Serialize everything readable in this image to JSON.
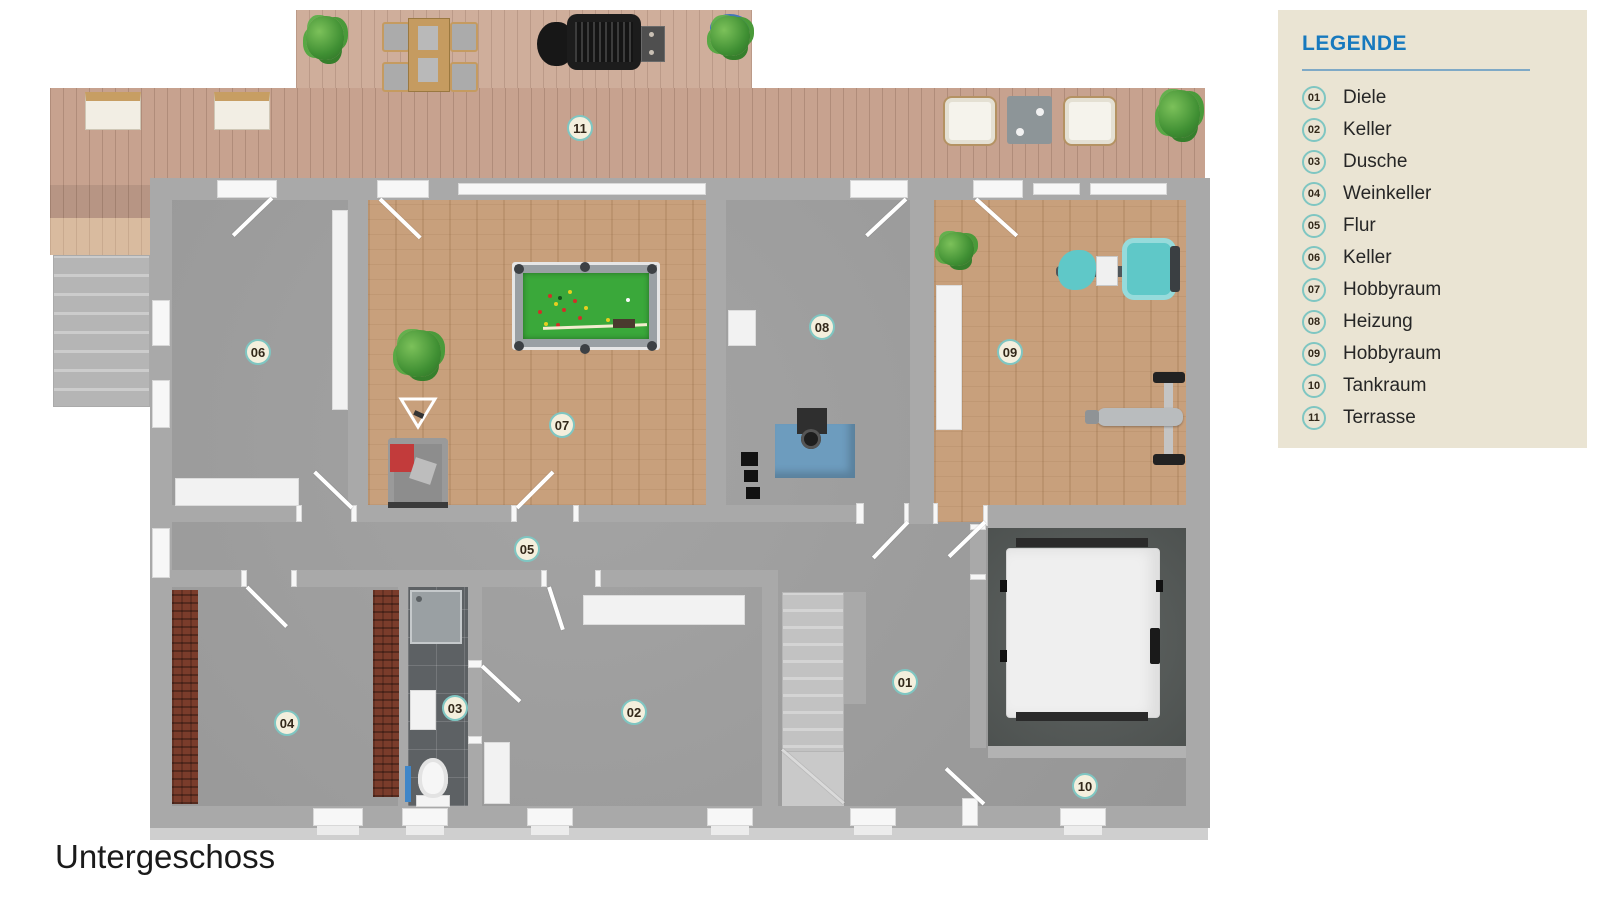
{
  "page": {
    "title": "Untergeschoss"
  },
  "legend": {
    "title": "LEGENDE",
    "items": [
      {
        "number": "01",
        "label": "Diele"
      },
      {
        "number": "02",
        "label": "Keller"
      },
      {
        "number": "03",
        "label": "Dusche"
      },
      {
        "number": "04",
        "label": "Weinkeller"
      },
      {
        "number": "05",
        "label": "Flur"
      },
      {
        "number": "06",
        "label": "Keller"
      },
      {
        "number": "07",
        "label": "Hobbyraum"
      },
      {
        "number": "08",
        "label": "Heizung"
      },
      {
        "number": "09",
        "label": "Hobbyraum"
      },
      {
        "number": "10",
        "label": "Tankraum"
      },
      {
        "number": "11",
        "label": "Terrasse"
      }
    ]
  },
  "floorplan": {
    "room_labels": [
      {
        "number": "01",
        "label": "Diele",
        "x": 905,
        "y": 682
      },
      {
        "number": "02",
        "label": "Keller",
        "x": 634,
        "y": 712
      },
      {
        "number": "03",
        "label": "Dusche",
        "x": 455,
        "y": 708
      },
      {
        "number": "04",
        "label": "Weinkeller",
        "x": 287,
        "y": 723
      },
      {
        "number": "05",
        "label": "Flur",
        "x": 527,
        "y": 549
      },
      {
        "number": "06",
        "label": "Keller",
        "x": 258,
        "y": 352
      },
      {
        "number": "07",
        "label": "Hobbyraum",
        "x": 562,
        "y": 425
      },
      {
        "number": "08",
        "label": "Heizung",
        "x": 822,
        "y": 327
      },
      {
        "number": "09",
        "label": "Hobbyraum",
        "x": 1010,
        "y": 352
      },
      {
        "number": "10",
        "label": "Tankraum",
        "x": 1085,
        "y": 786
      },
      {
        "number": "11",
        "label": "Terrasse",
        "x": 580,
        "y": 128
      }
    ]
  },
  "colors": {
    "accent_blue": "#1779be",
    "legend_bg": "#eae4d3",
    "badge_ring": "#7fc6c2",
    "badge_bg": "#f4efdd",
    "wall": "#a9a9a9",
    "gray_floor": "#9e9e9e",
    "wood_floor": "#c8a07c",
    "tile_dark": "#5d6164",
    "pool_green": "#3aa83a",
    "furnace_blue": "#6d9cbe",
    "gym_teal": "#5fc8c8",
    "wine_brown": "#7a3c2b"
  }
}
